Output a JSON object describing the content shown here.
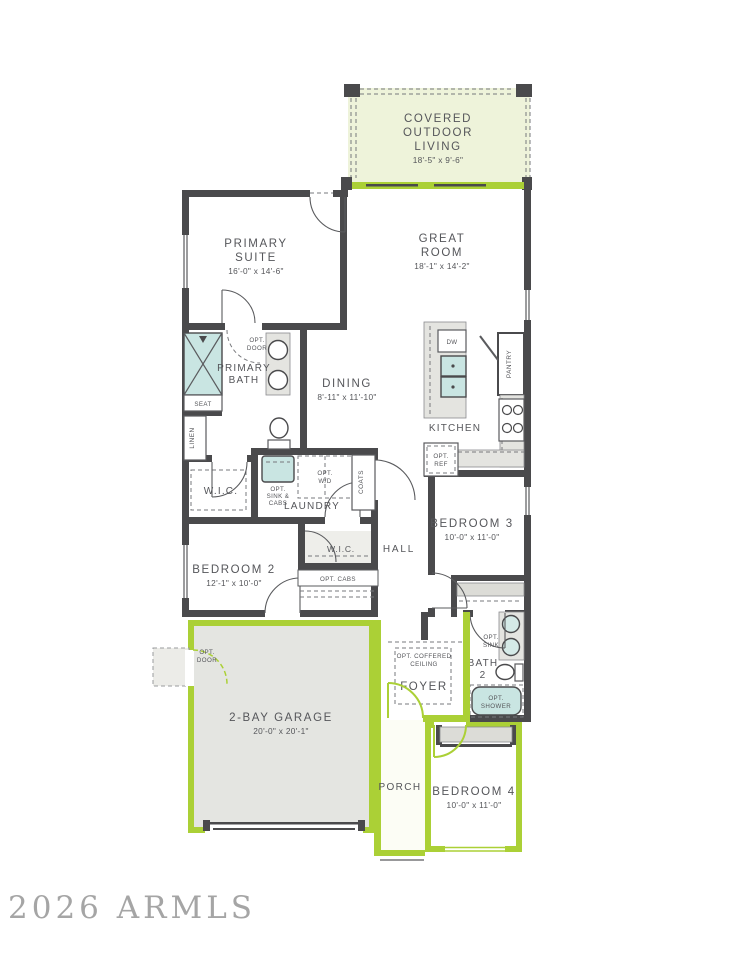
{
  "watermark": "2026 ARMLS",
  "colors": {
    "wall": "#4a4a4c",
    "accent_green": "#abd036",
    "pale_green_fill": "#eef3da",
    "fixture_teal": "#c9e5e2",
    "light_gray": "#e4e4e0",
    "label_text": "#55565a"
  },
  "rooms": {
    "covered_outdoor_living": {
      "l1": "COVERED",
      "l2": "OUTDOOR",
      "l3": "LIVING",
      "dims": "18'-5\" x 9'-6\""
    },
    "primary_suite": {
      "l1": "PRIMARY",
      "l2": "SUITE",
      "dims": "16'-0\" x 14'-6\""
    },
    "great_room": {
      "l1": "GREAT",
      "l2": "ROOM",
      "dims": "18'-1\" x 14'-2\""
    },
    "primary_bath": {
      "l1": "PRIMARY",
      "l2": "BATH"
    },
    "dining": {
      "l1": "DINING",
      "dims": "8'-11\" x 11'-10\""
    },
    "kitchen": {
      "l1": "KITCHEN"
    },
    "wic_primary": {
      "l1": "W.I.C."
    },
    "laundry": {
      "l1": "LAUNDRY"
    },
    "bedroom_2": {
      "l1": "BEDROOM 2",
      "dims": "12'-1\" x 10'-0\""
    },
    "wic_bedroom_2": {
      "l1": "W.I.C."
    },
    "hall": {
      "l1": "HALL"
    },
    "bedroom_3": {
      "l1": "BEDROOM 3",
      "dims": "10'-0\" x 11'-0\""
    },
    "bath_2": {
      "l1": "BATH",
      "l2": "2"
    },
    "foyer": {
      "l1": "FOYER"
    },
    "garage": {
      "l1": "2-BAY GARAGE",
      "dims": "20'-0\" x 20'-1\""
    },
    "porch": {
      "l1": "PORCH"
    },
    "bedroom_4": {
      "l1": "BEDROOM 4",
      "dims": "10'-0\" x 11'-0\""
    }
  },
  "annotations": {
    "opt_door_bath": {
      "l1": "OPT.",
      "l2": "DOOR"
    },
    "seat": "SEAT",
    "linen": "LINEN",
    "dw": "DW",
    "pantry": "PANTRY",
    "opt_ref": {
      "l1": "OPT.",
      "l2": "REF"
    },
    "opt_sink_cabs": {
      "l1": "OPT.",
      "l2": "SINK &",
      "l3": "CABS"
    },
    "opt_wd": {
      "l1": "OPT.",
      "l2": "W/D"
    },
    "coats": "COATS",
    "opt_cabs": "OPT. CABS",
    "opt_sink": {
      "l1": "OPT.",
      "l2": "SINK"
    },
    "opt_shower": {
      "l1": "OPT.",
      "l2": "SHOWER"
    },
    "opt_coffered": {
      "l1": "OPT. COFFERED",
      "l2": "CEILING"
    },
    "opt_door_garage": {
      "l1": "OPT.",
      "l2": "DOOR"
    }
  }
}
